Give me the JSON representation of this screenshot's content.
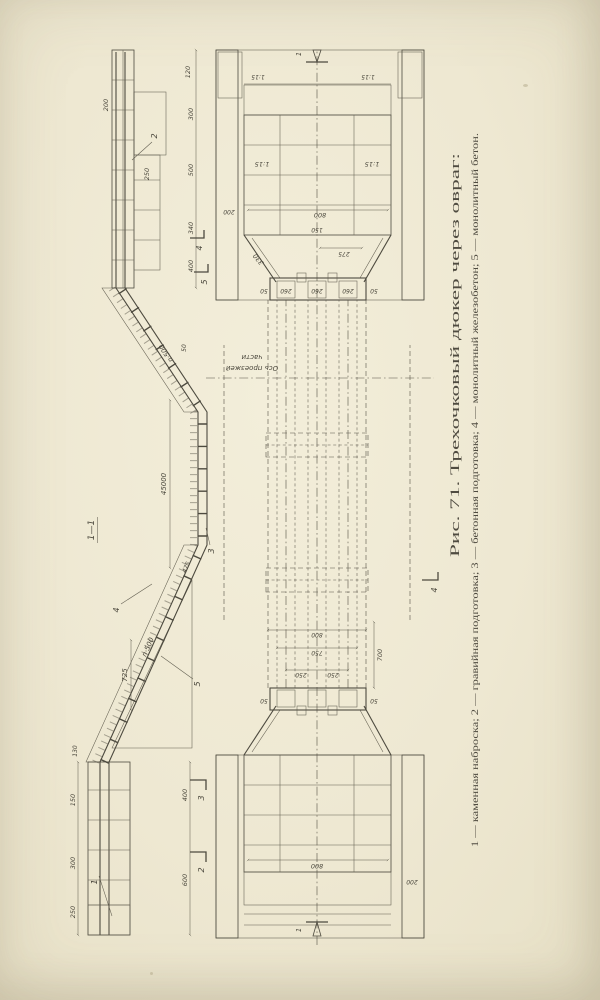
{
  "caption": {
    "title": "Рис. 71. Трехочковый дюкер через овраг:",
    "legend": "1 — каменная наброска; 2 — гравийная подготовка; 3 — бетонная подготовка; 4 — монолитный железобетон; 5 — монолитный бетон."
  },
  "views": {
    "section_label": "1—1",
    "road_axis_line1": "Ось проезжей",
    "road_axis_line2": "части"
  },
  "dims": {
    "total_length": "45000",
    "n500": "n·500",
    "d725": "725",
    "d800": "800",
    "d750": "750",
    "d700": "700",
    "d600": "600",
    "d500": "500",
    "d475": "475",
    "d400": "400",
    "d340": "340",
    "d330": "330",
    "d300": "300",
    "d275": "275",
    "d260": "260",
    "d250": "250",
    "d200": "200",
    "d150": "150",
    "d130": "130",
    "d120": "120",
    "d50": "50",
    "slope_1_15": "1:15"
  },
  "leaders": {
    "k1": "1",
    "k2": "2",
    "k3": "3",
    "k4": "4",
    "k5": "5"
  },
  "colors": {
    "paper": "#f0ebd7",
    "ink": "#4d4a3f"
  }
}
